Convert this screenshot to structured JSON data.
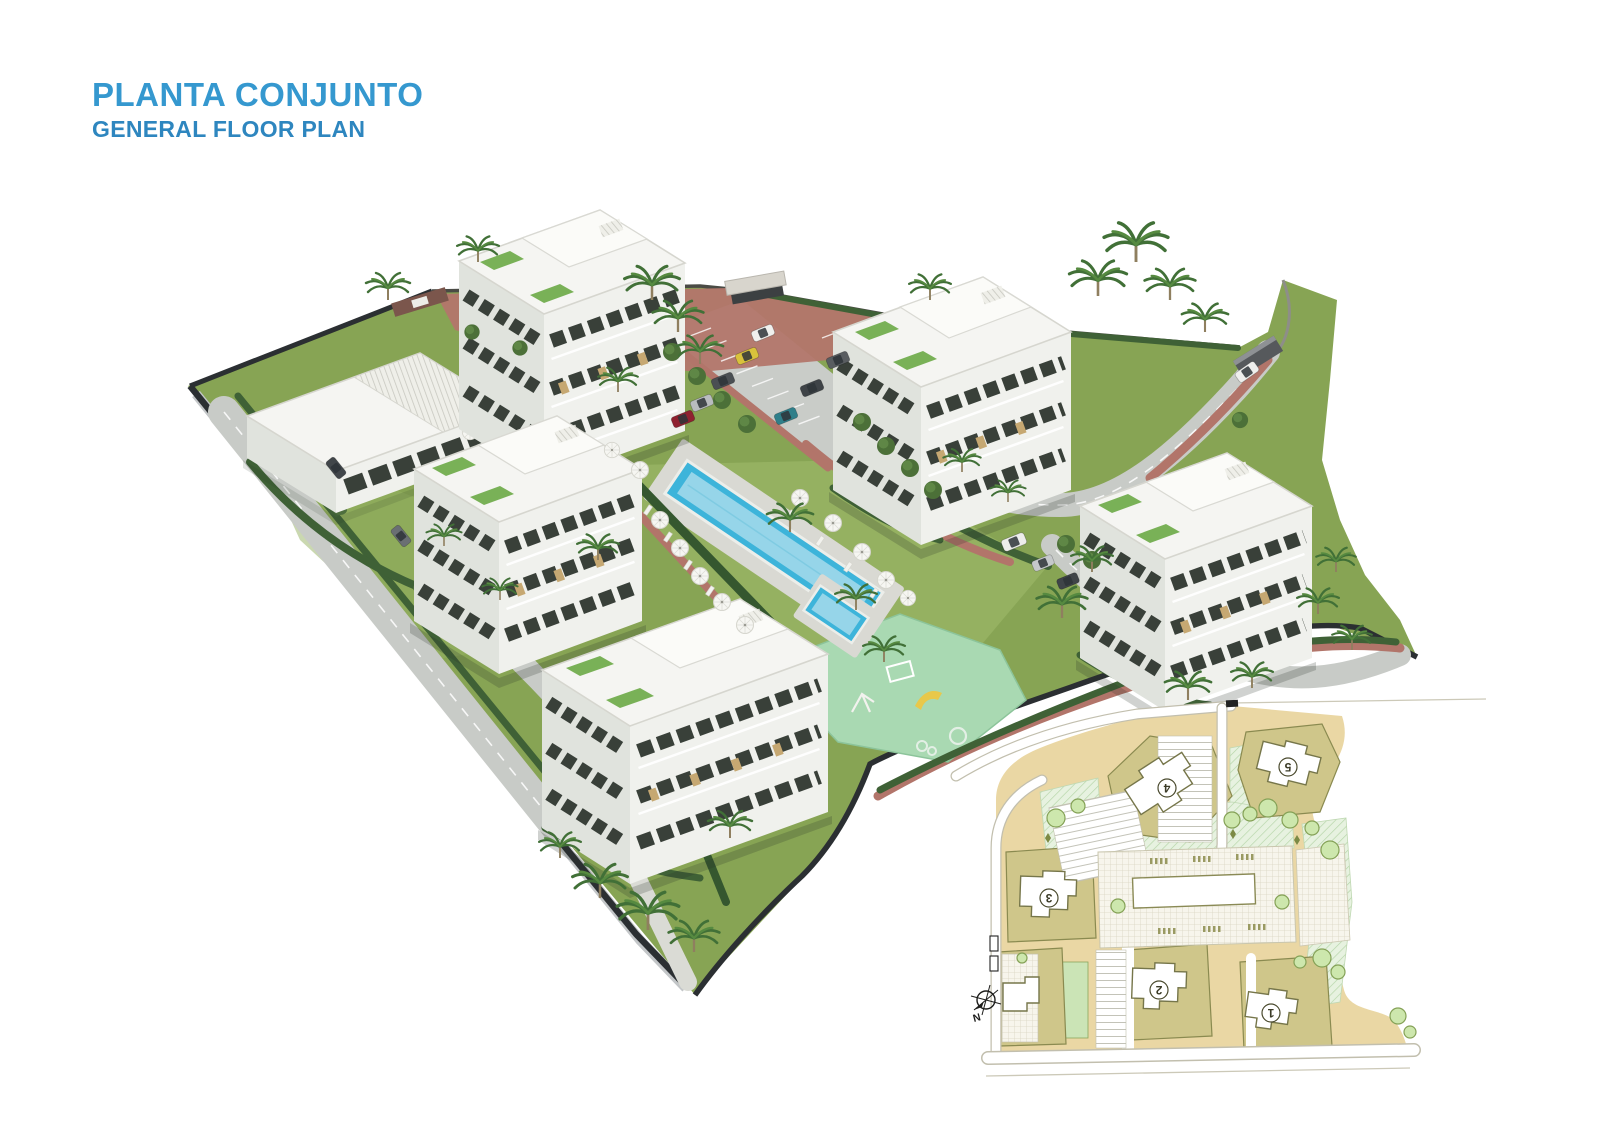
{
  "header": {
    "title": "PLANTA CONJUNTO",
    "subtitle": "GENERAL FLOOR PLAN",
    "title_color": "#3598CF",
    "subtitle_color": "#2E86BF"
  },
  "palette": {
    "grass": "#87A454",
    "grass_light": "#95B161",
    "road": "#C8CBC7",
    "brick_path": "#B2756A",
    "pool_water": "#3DB4DA",
    "pool_water_light": "#A6DBEB",
    "playground": "#A9D9B2",
    "hedge": "#3F6136",
    "boundary": "#2B2F32",
    "building_white": "#F5F5F2",
    "window_dark": "#394039",
    "inset_sand": "#EAD7A4",
    "inset_plot": "#CFC68A",
    "inset_green": "#E7F2E0"
  },
  "inset": {
    "buildings": [
      {
        "label": "1"
      },
      {
        "label": "2"
      },
      {
        "label": "3"
      },
      {
        "label": "4"
      },
      {
        "label": "5"
      }
    ],
    "compass": {
      "north_label": "N"
    }
  }
}
